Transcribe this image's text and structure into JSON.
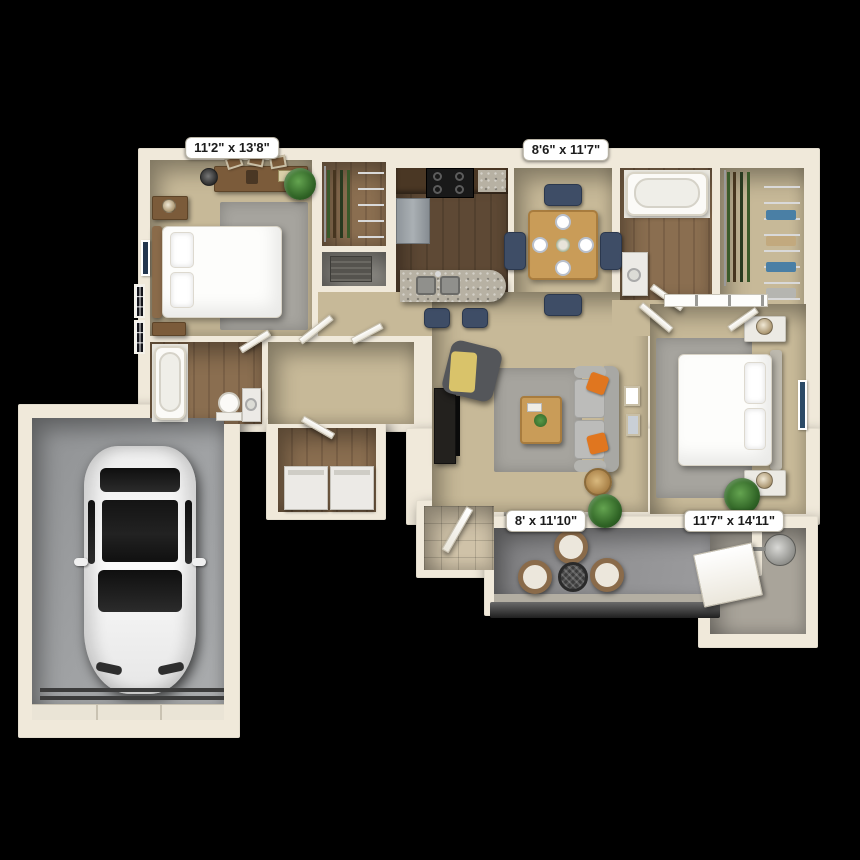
{
  "scene": {
    "type": "3d-floor-plan-render",
    "view": "top-down",
    "background_color": "#000000"
  },
  "labels": {
    "bedroom_one": "11'2\" x 13'8\"",
    "dining": "8'6\" x 11'7\"",
    "patio": "8' x 11'10\"",
    "bedroom_two": "11'7\" x 14'11\""
  },
  "rooms": [
    {
      "id": "bedroom-1",
      "dimensions": "11'2\" x 13'8\"",
      "features": [
        "bed",
        "dresser",
        "nightstands",
        "rug",
        "windows",
        "wall-art",
        "plant",
        "walk-in-closet"
      ]
    },
    {
      "id": "dining-kitchen",
      "dimensions": "8'6\" x 11'7\"",
      "features": [
        "dining-table",
        "four-chairs",
        "breakfast-bar",
        "double-sink",
        "stove",
        "fridge",
        "bar-stools"
      ]
    },
    {
      "id": "living-room",
      "features": [
        "sofa",
        "orange-pillows",
        "armchair",
        "coffee-table",
        "tv-console",
        "side-table",
        "rug",
        "gallery-frames",
        "plant"
      ]
    },
    {
      "id": "bedroom-2",
      "dimensions": "11'7\" x 14'11\"",
      "features": [
        "bed",
        "nightstands-with-lamps",
        "rug",
        "wall-art",
        "plant",
        "walk-in-closet",
        "bathroom"
      ]
    },
    {
      "id": "patio",
      "dimensions": "8' x 11'10\"",
      "features": [
        "three-wicker-chairs",
        "mesh-table",
        "railing",
        "storage-closet",
        "water-heater"
      ]
    },
    {
      "id": "bathroom-1",
      "features": [
        "tub",
        "toilet",
        "vanity"
      ]
    },
    {
      "id": "bathroom-2",
      "features": [
        "tub",
        "vanity"
      ]
    },
    {
      "id": "laundry",
      "features": [
        "washer",
        "dryer"
      ]
    },
    {
      "id": "garage",
      "features": [
        "white-car",
        "garage-door"
      ]
    }
  ],
  "colors": {
    "bg": "#000000",
    "wall": "#f0e9da",
    "carpet": "#c7b998",
    "wood-dark": "#5e4935",
    "wood-mid": "#8a6e50",
    "tile": "#cfc2a8",
    "patio": "#909092",
    "garage": "#9fa1a3",
    "rug": "#a6a49e",
    "sofa": "#bcbcba",
    "orange": "#e0761f",
    "navy": "#3e4d66",
    "table-wood": "#c99c58",
    "cabinet": "#4a3724",
    "granite": "#b7b1a3",
    "label-bg": "#ffffff",
    "label-text": "#1c1c1c"
  }
}
